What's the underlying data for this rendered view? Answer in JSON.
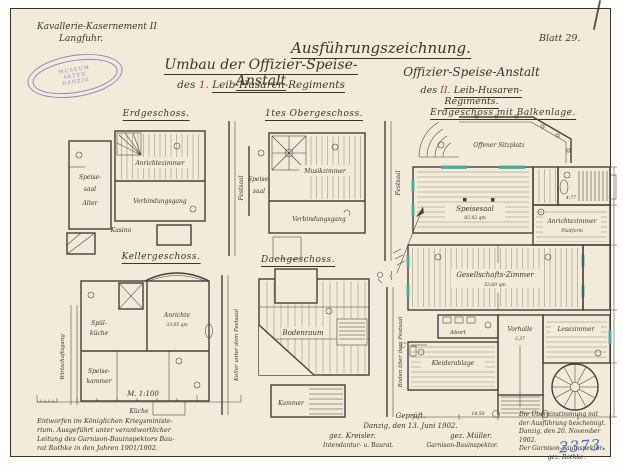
{
  "header": {
    "office_line1": "Kavallerie-Kasernement II",
    "office_line2": "Langfuhr.",
    "corner_mark": "1",
    "sheet": "Blatt 29.",
    "title_left_main": "Umbau der Offizier-Speise-Anstalt",
    "title_left_sub_prefix": "des",
    "title_left_sub_num": "1.",
    "title_left_sub_rest": "Leib-Husaren-Regiments",
    "title_right_main": "Ausführungszeichnung.",
    "title_right_sub1": "Offizier-Speise-Anstalt",
    "title_right_sub2_prefix": "des",
    "title_right_sub2_num": "II.",
    "title_right_sub2_rest": "Leib-Husaren-Regiments."
  },
  "stamp": {
    "top": "MUSEUM",
    "mid": "AKTEN",
    "bottom": "DANZIG"
  },
  "plans": {
    "eg": {
      "title": "Erdgeschoss.",
      "room_left1": "Speise-",
      "room_left2": "saal",
      "room_left3": "Alter",
      "room_main": "Anrichtezimmer",
      "corridor": "Verbindungsgang",
      "room_bottom": "Kasino",
      "adjacent": "Festsaal"
    },
    "og": {
      "title": "1tes Obergeschoss.",
      "room_left1": "Speise-",
      "room_left2": "saal",
      "room_main": "Musikzimmer",
      "corridor": "Verbindungsgang",
      "adjacent": "Festsaal"
    },
    "kg": {
      "title": "Kellergeschoss.",
      "room1": "Spül-",
      "room1b": "küche",
      "room2": "Anrichte",
      "room2_area": "33,05 qm",
      "room3": "Speise-",
      "room3b": "kammer",
      "room_bottom": "Küche",
      "gang": "Wirtschaftsgang",
      "adjacent": "Keller unter dem Festsaal"
    },
    "dg": {
      "title": "Dachgeschoss.",
      "room_main": "Bodenraum",
      "room_bottom": "Kammer",
      "adjacent": "Boden über dem Festsaal"
    },
    "big": {
      "title": "Erdgeschoss mit Balkenlage.",
      "terrace": "Offener Sitzplatz",
      "hall": "Speisesaal",
      "hall_area": "82,42 qm",
      "anrichte": "Anrichtezimmer",
      "plattform": "Plattform",
      "salon": "Gesellschafts-Zimmer",
      "salon_area": "53,60 qm",
      "abort": "Abort",
      "garderobe": "Kleiderablage",
      "vorhalle": "Vorhalle",
      "lese": "Lesezimmer",
      "section_mark": "C",
      "dims": [
        "14,50",
        "2,37",
        "4,77"
      ]
    }
  },
  "scale": {
    "label": "M. 1:100"
  },
  "notes": {
    "provenance": [
      "Entworfen im Königlichen Kriegsministe-",
      "rium. Ausgeführt unter verantwortlicher",
      "Leitung des Garnison-Bauinspektors Bau-",
      "rat Rothke in den Jahren 1901/1902."
    ],
    "approval": {
      "l1": "Geprüft.",
      "l2": "Danzig, den 13. Juni 1902.",
      "sig1": "gez. Kreisler.",
      "sig2": "gez. Müller.",
      "role1": "Intendantur- u. Baurat.",
      "role2": "Garnison-Bauinspektor."
    },
    "certification": [
      "Die Übereinstimmung mit",
      "der Ausführung bescheinigt.",
      "Danzig, den 20. November 1902.",
      "Der Garnison-Bauinspektor.",
      "gez. Rothke."
    ],
    "archive_no": "2373."
  },
  "colors": {
    "paper": "#f2ebd9",
    "ink": "#3a352c",
    "red_ink": "#96443a",
    "stamp": "#8268b6",
    "archive_blue": "#3f6fbe",
    "window_accent": "#4aaf9e"
  }
}
